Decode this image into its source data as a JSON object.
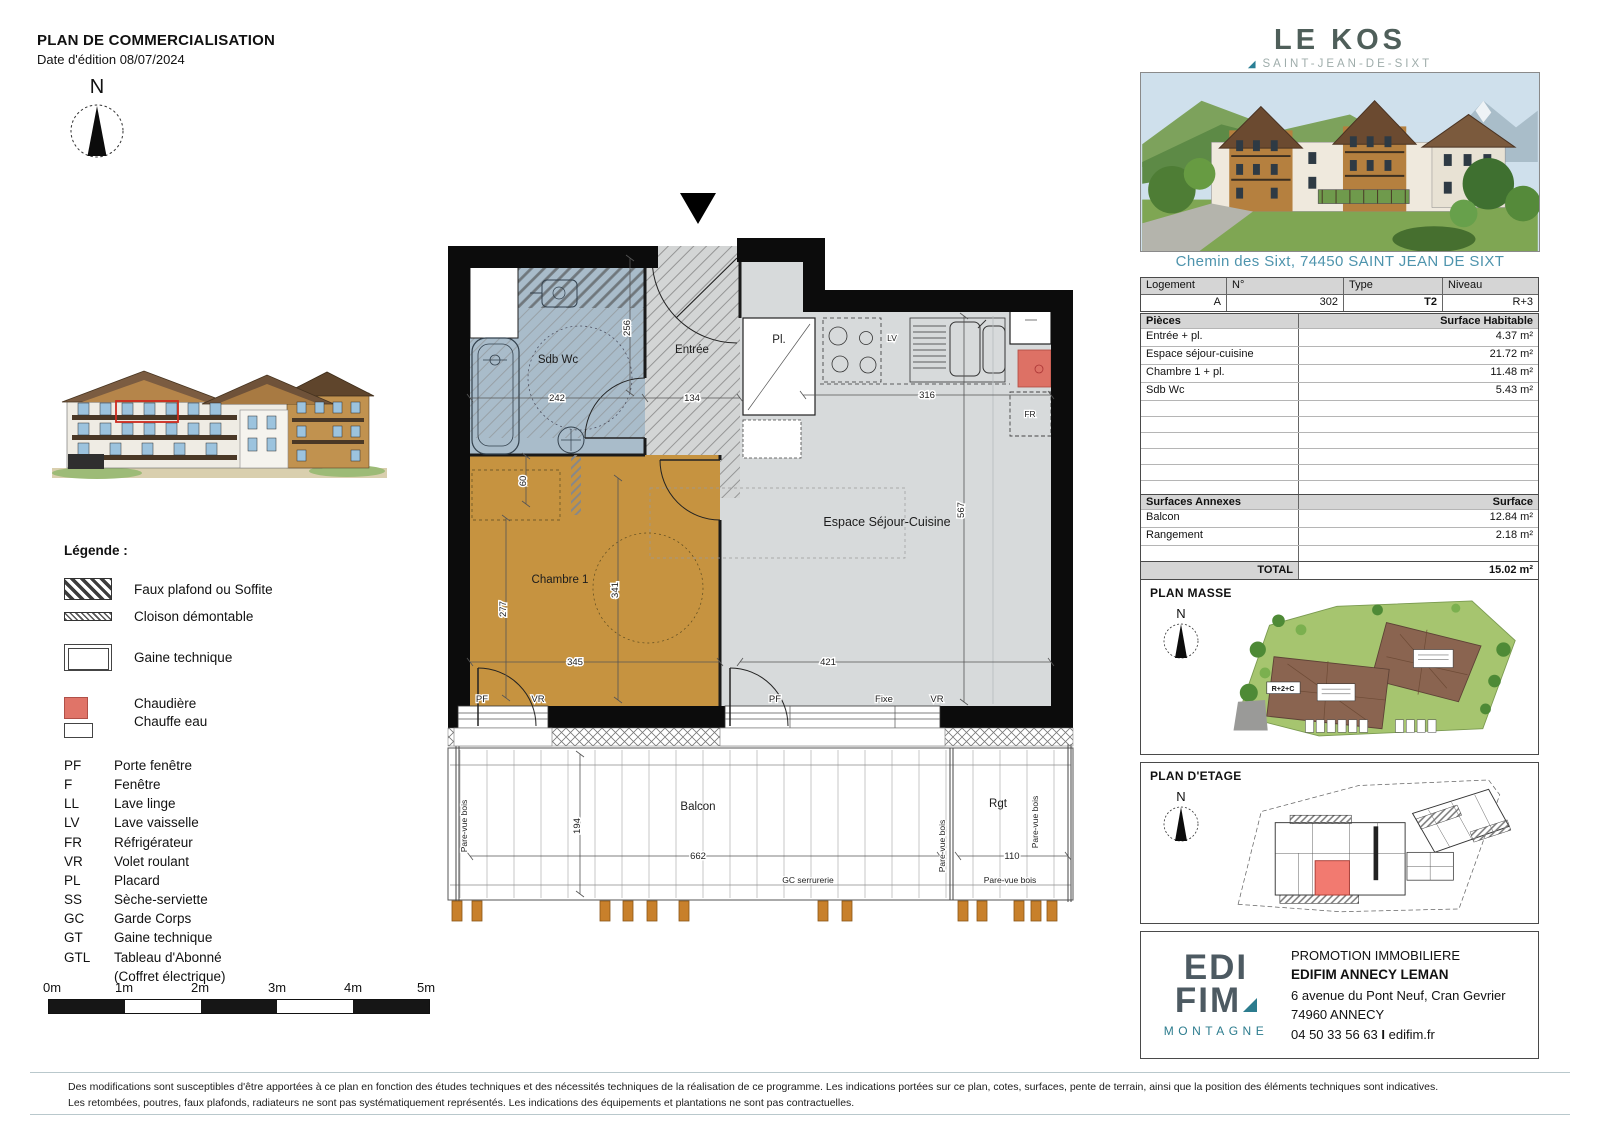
{
  "doc": {
    "title": "PLAN DE COMMERCIALISATION",
    "edition": "Date d'édition 08/07/2024"
  },
  "compass_n": "N",
  "legend": {
    "title": "Légende :",
    "swatches": [
      {
        "label": "Faux plafond ou Soffite"
      },
      {
        "label": "Cloison démontable"
      },
      {
        "label": "Gaine technique"
      },
      {
        "label": "Chaudière",
        "label2": "Chauffe eau"
      }
    ],
    "abbr": [
      {
        "abbr": "PF",
        "label": "Porte fenêtre"
      },
      {
        "abbr": "F",
        "label": "Fenêtre"
      },
      {
        "abbr": "LL",
        "label": "Lave linge"
      },
      {
        "abbr": "LV",
        "label": "Lave vaisselle"
      },
      {
        "abbr": "FR",
        "label": "Réfrigérateur"
      },
      {
        "abbr": "VR",
        "label": "Volet roulant"
      },
      {
        "abbr": "PL",
        "label": "Placard"
      },
      {
        "abbr": "SS",
        "label": "Sèche-serviette"
      },
      {
        "abbr": "GC",
        "label": "Garde Corps"
      },
      {
        "abbr": "GT",
        "label": "Gaine technique"
      },
      {
        "abbr": "GTL",
        "label": "Tableau d'Abonné",
        "label2": "(Coffret électrique)"
      }
    ]
  },
  "scalebar": {
    "labels": [
      "0m",
      "1m",
      "2m",
      "3m",
      "4m",
      "5m"
    ]
  },
  "floorplan": {
    "rooms": {
      "sdb": "Sdb Wc",
      "entree": "Entrée",
      "placard": "Pl.",
      "sejour": "Espace Séjour-Cuisine",
      "chambre": "Chambre 1",
      "balcon": "Balcon",
      "rangement": "Rgt"
    },
    "dims": {
      "d242": "242",
      "d256": "256",
      "d134": "134",
      "d316": "316",
      "d567": "567",
      "d60": "60",
      "d277": "277",
      "d341": "341",
      "d345": "345",
      "d421": "421",
      "d194": "194",
      "d662": "662",
      "d110": "110"
    },
    "labels": {
      "pf": "PF",
      "vr": "VR",
      "fixe": "Fixe",
      "lv": "LV",
      "fr": "FR",
      "gc": "GC serrurerie",
      "pare_vue": "Pare-vue bois"
    }
  },
  "brand": {
    "name": "LE KOS",
    "marker": "◢",
    "location": "SAINT-JEAN-DE-SIXT"
  },
  "address": "Chemin des Sixt, 74450 SAINT JEAN DE SIXT",
  "unit_table": {
    "headers": [
      "Logement",
      "N°",
      "Type",
      "Niveau"
    ],
    "values": [
      "A",
      "302",
      "T2",
      "R+3"
    ]
  },
  "pieces_table": {
    "header_left": "Pièces",
    "header_right": "Surface Habitable",
    "rows": [
      {
        "name": "Entrée + pl.",
        "value": "4.37 m²"
      },
      {
        "name": "Espace séjour-cuisine",
        "value": "21.72 m²"
      },
      {
        "name": "Chambre 1 + pl.",
        "value": "11.48 m²"
      },
      {
        "name": "Sdb Wc",
        "value": "5.43 m²"
      }
    ],
    "total_label": "TOTAL",
    "total_value": "43.00 m²"
  },
  "annexes_table": {
    "header_left": "Surfaces Annexes",
    "header_right": "Surface",
    "rows": [
      {
        "name": "Balcon",
        "value": "12.84 m²"
      },
      {
        "name": "Rangement",
        "value": "2.18 m²"
      }
    ],
    "total_label": "TOTAL",
    "total_value": "15.02 m²"
  },
  "plan_masse": {
    "title": "PLAN MASSE",
    "building_label": "R+2+C"
  },
  "plan_etage": {
    "title": "PLAN D'ETAGE"
  },
  "promoter": {
    "line1": "PROMOTION IMMOBILIERE",
    "name": "EDIFIM ANNECY LEMAN",
    "address1": "6 avenue du Pont Neuf, Cran Gevrier",
    "address2": "74960 ANNECY",
    "phone": "04 50 33 56 63",
    "sep": "I",
    "web": "edifim.fr",
    "logo_top": "EDI",
    "logo_bottom": "FIM",
    "logo_sub": "MONTAGNE"
  },
  "footer": {
    "line1": "Des modifications sont susceptibles d'être apportées à ce plan en fonction des études techniques et des nécessités techniques de la réalisation de ce programme. Les indications portées sur ce plan, cotes, surfaces, pente de terrain, ainsi que la position des éléments techniques sont indicatives.",
    "line2": "Les retombées, poutres, faux plafonds, radiateurs ne sont pas systématiquement représentés. Les indications des équipements et plantations ne sont pas contractuelles."
  }
}
